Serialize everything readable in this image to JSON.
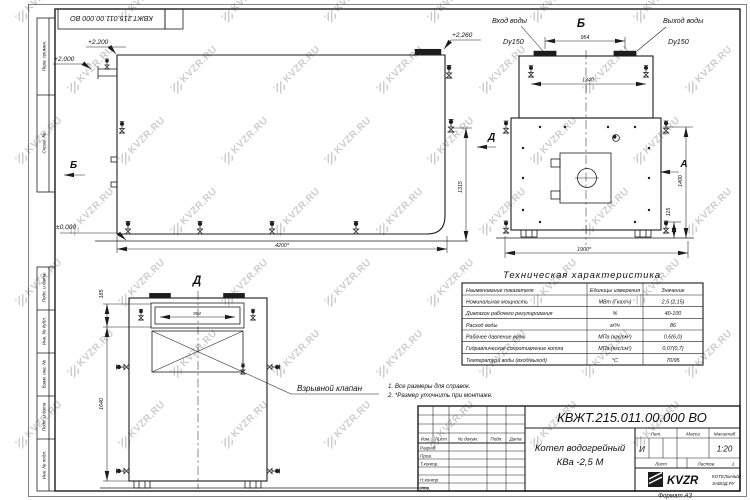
{
  "meta": {
    "watermark": "KVZR.RU",
    "format_label": "Формат А3"
  },
  "frame": {
    "top_stamp": "КВЖТ.215.011.00.000 ВО",
    "left_top": [
      "Перв. примен.",
      "Справ. №"
    ],
    "left_bottom": [
      "Подп. и дата",
      "Инв. № дубл.",
      "Взам. инв. №",
      "Подп. и дата",
      "Инв. № подл."
    ]
  },
  "views": {
    "side": {
      "section_label": "Б",
      "view_label": "Д",
      "elev_top_flange": "+2,260",
      "elev_roof": "+2,200",
      "elev_nozzle": "+2,000",
      "elev_zero": "±0,000",
      "dim_length": "4200*",
      "dim_height": "1315"
    },
    "top": {
      "title": "Б",
      "inlet_name": "Вход воды",
      "inlet_size": "Dy150",
      "outlet_name": "Выход воды",
      "outlet_size": "Dy150",
      "dim_nozzles": "954",
      "dim_lugs": "1340",
      "dim_width": "1900*",
      "dim_height": "1400",
      "dim_skid": "115",
      "section_a": "А"
    },
    "front": {
      "title": "Д",
      "dim_window": "954",
      "dim_top": "185",
      "dim_height": "1640",
      "callout": "Взрывной клапан"
    }
  },
  "notes": {
    "line1": "1. Все размеры для справок.",
    "line2": "2. *Размер уточнить при монтаже."
  },
  "spec_table": {
    "title": "Техническая характеристика",
    "headers": [
      "Наименование показателя",
      "Единицы измерения",
      "Значение"
    ],
    "rows": [
      [
        "Номинальная мощность",
        "МВт (Гкал/ч)",
        "2,5 (2,15)"
      ],
      [
        "Диапазон рабочего регулирования",
        "%",
        "40-100"
      ],
      [
        "Расход воды",
        "м³/ч",
        "86"
      ],
      [
        "Рабочее давление воды",
        "МПа (кгс/см²)",
        "0,6(6,0)"
      ],
      [
        "Гидравлическое сопротивление котла",
        "МПа (кгс/см²)",
        "0,07(0,7)"
      ],
      [
        "Температура воды (вход/выход)",
        "°С",
        "70/95"
      ]
    ]
  },
  "title_block": {
    "doc_number": "КВЖТ.215.011.00.000 ВО",
    "product_line1": "Котел водогрейный",
    "product_line2": "КВа -2,5  М",
    "rev_headers": [
      "Изм.",
      "Лист",
      "№ докум.",
      "Подп.",
      "Дата"
    ],
    "sign_rows": [
      "Разраб.",
      "Пров.",
      "Т.контр.",
      "Н.контр.",
      "Утв."
    ],
    "lit_label": "Лит.",
    "lit_value": "И",
    "mass_label": "Масса",
    "scale_label": "Масштаб",
    "scale_value": "1:20",
    "sheet_label": "Лист",
    "sheets_label": "Листов",
    "sheets_value": "1",
    "brand": "KVZR",
    "brand_line1": "КОТЕЛЬНЫЙ",
    "brand_line2": "ЗАВОД.РУ"
  }
}
